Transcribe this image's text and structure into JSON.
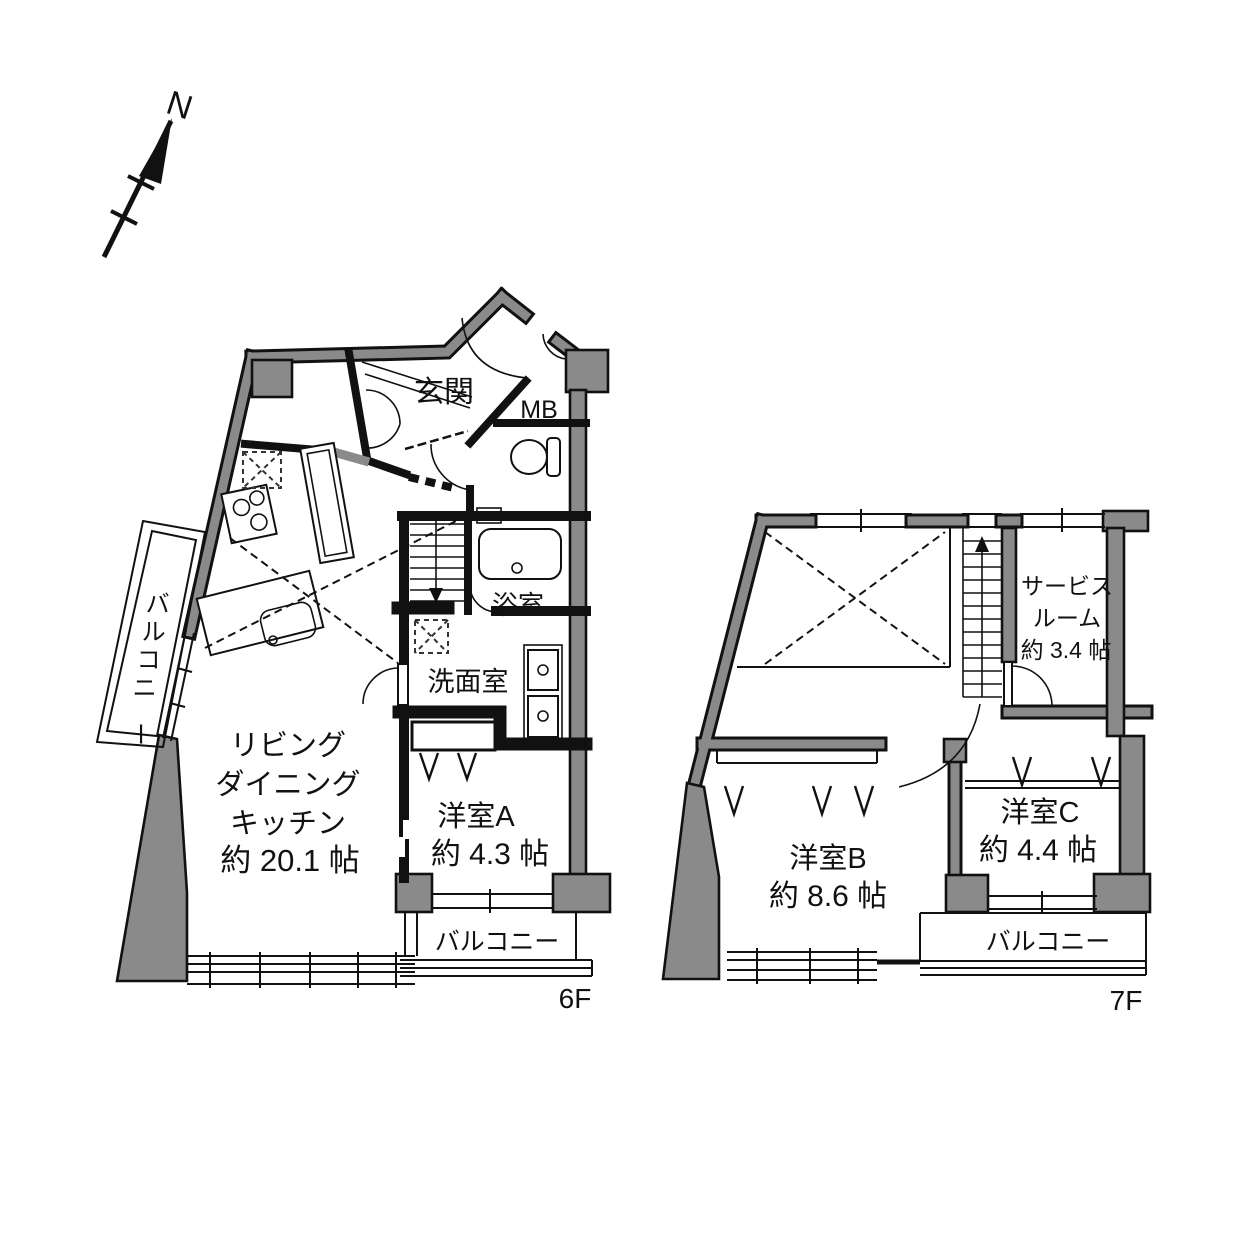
{
  "compass": {
    "label": "N"
  },
  "colors": {
    "wall_fill": "#8a8a8a",
    "line": "#111111",
    "background": "#ffffff"
  },
  "floor6": {
    "floor_label": "6F",
    "rooms": {
      "entrance": "玄関",
      "meter_box": "MB",
      "bathroom": "浴室",
      "washroom": "洗面室",
      "ldk_line1": "リビング",
      "ldk_line2": "ダイニング",
      "ldk_line3": "キッチン",
      "ldk_size": "約 20.1 帖",
      "room_a": "洋室A",
      "room_a_size": "約 4.3 帖",
      "balcony_side_chars": [
        "バ",
        "ル",
        "コ",
        "ニ",
        "ー"
      ],
      "balcony_bottom": "バルコニー"
    }
  },
  "floor7": {
    "floor_label": "7F",
    "rooms": {
      "service_room_line1": "サービス",
      "service_room_line2": "ルーム",
      "service_room_size": "約 3.4 帖",
      "room_b": "洋室B",
      "room_b_size": "約 8.6 帖",
      "room_c": "洋室C",
      "room_c_size": "約 4.4 帖",
      "balcony": "バルコニー"
    }
  }
}
